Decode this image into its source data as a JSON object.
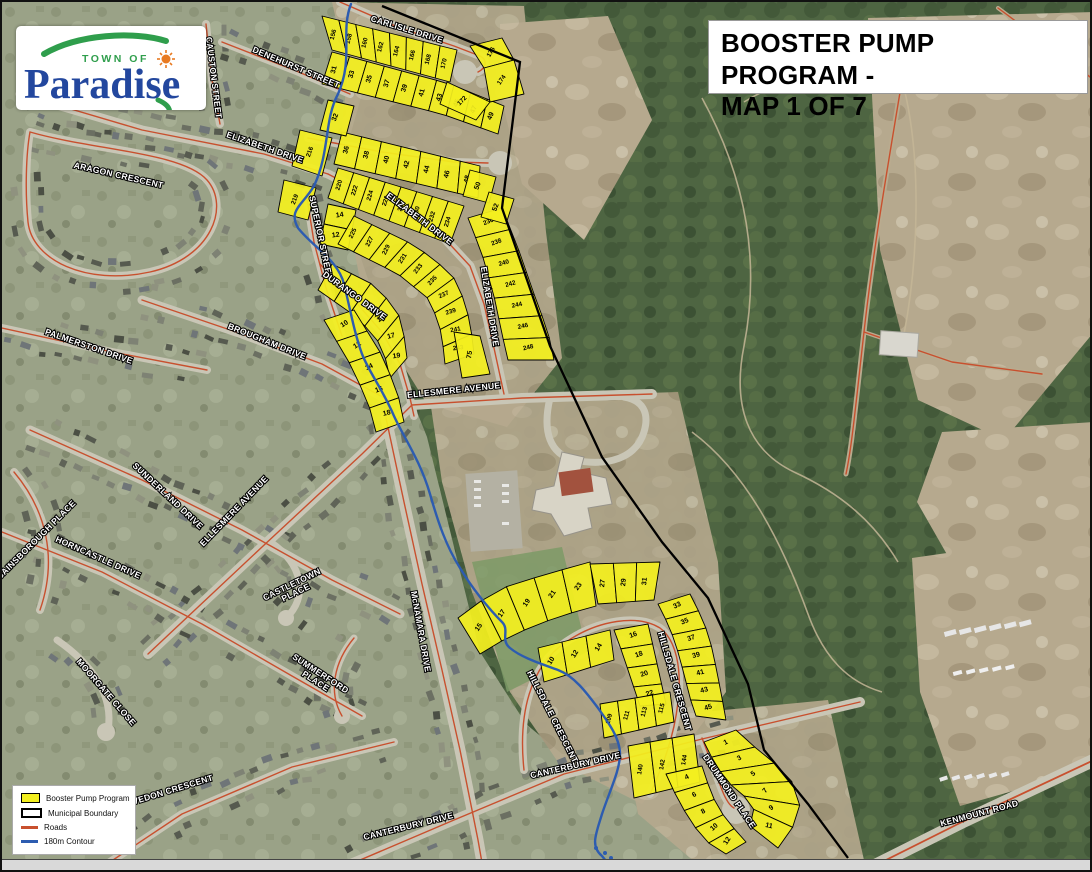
{
  "logo": {
    "top": "TOWN OF",
    "name": "Paradise"
  },
  "title_box": {
    "line1": "BOOSTER PUMP PROGRAM -",
    "line2": "MAP 1 OF 7"
  },
  "legend": {
    "items": [
      {
        "label": "Booster Pump Program",
        "type": "fill",
        "color": "#f3ef1f"
      },
      {
        "label": "Municipal Boundary",
        "type": "outline",
        "color": "#000000"
      },
      {
        "label": "Roads",
        "type": "line",
        "color": "#c8502e"
      },
      {
        "label": "180m Contour",
        "type": "line-thick",
        "color": "#2d5cb0"
      }
    ]
  },
  "map": {
    "colors": {
      "parcel": "#f3ef1f",
      "parcel_stroke": "#000000",
      "road_center": "#c8502e",
      "contour": "#2d5cb0",
      "boundary": "#000000"
    },
    "street_labels": [
      {
        "text": "CARLISLE DRIVE",
        "x": 404,
        "y": 30,
        "rot": 17
      },
      {
        "text": "ELIZABETH DRIVE",
        "x": 262,
        "y": 148,
        "rot": 19
      },
      {
        "text": "DENEHURST STREET",
        "x": 293,
        "y": 68,
        "rot": 23
      },
      {
        "text": "CAUSTON STREET",
        "x": 209,
        "y": 76,
        "rot": 83
      },
      {
        "text": "ARAGON CRESCENT",
        "x": 116,
        "y": 176,
        "rot": 13
      },
      {
        "text": "SUPERIOR STREET",
        "x": 316,
        "y": 236,
        "rot": 78
      },
      {
        "text": "ELIZABETH DRIVE",
        "x": 416,
        "y": 219,
        "rot": 37
      },
      {
        "text": "ELIZABETH DRIVE",
        "x": 485,
        "y": 305,
        "rot": 81
      },
      {
        "text": "DURANGO DRIVE",
        "x": 351,
        "y": 296,
        "rot": 36
      },
      {
        "text": "BROUGHAM DRIVE",
        "x": 264,
        "y": 342,
        "rot": 22
      },
      {
        "text": "PALMERSTON DRIVE",
        "x": 86,
        "y": 347,
        "rot": 19
      },
      {
        "text": "ELLESMERE AVENUE",
        "x": 452,
        "y": 391,
        "rot": -6
      },
      {
        "text": "ELLESMERE AVENUE",
        "x": 234,
        "y": 511,
        "rot": -46
      },
      {
        "text": "SUNDERLAND DRIVE",
        "x": 164,
        "y": 496,
        "rot": 43
      },
      {
        "text": "HORNCASTLE DRIVE",
        "x": 95,
        "y": 558,
        "rot": 24
      },
      {
        "text": "GAINSBOROUGH PLACE",
        "x": 36,
        "y": 540,
        "rot": -45
      },
      {
        "text": "CASTLETOWN",
        "line2": "PLACE",
        "x": 291,
        "y": 585,
        "rot": -26
      },
      {
        "text": "MOORGATE CLOSE",
        "x": 102,
        "y": 692,
        "rot": 49
      },
      {
        "text": "CLEVEDON CRESCENT",
        "x": 163,
        "y": 793,
        "rot": -17
      },
      {
        "text": "SUMMERFORD",
        "line2": "PLACE",
        "x": 317,
        "y": 674,
        "rot": 33
      },
      {
        "text": "McNAMARA DRIVE",
        "x": 416,
        "y": 630,
        "rot": 80
      },
      {
        "text": "HILLSDALE CRESCENT",
        "x": 548,
        "y": 716,
        "rot": 63
      },
      {
        "text": "HILLSDALE CRESCENT",
        "x": 670,
        "y": 680,
        "rot": 74
      },
      {
        "text": "CANTERBURY DRIVE",
        "x": 574,
        "y": 766,
        "rot": -13
      },
      {
        "text": "CANTERBURY DRIVE",
        "x": 407,
        "y": 827,
        "rot": -14
      },
      {
        "text": "DRUMMOND PLACE",
        "x": 725,
        "y": 791,
        "rot": 56
      },
      {
        "text": "KENMOUNT ROAD",
        "x": 978,
        "y": 814,
        "rot": -15
      }
    ],
    "parcel_strips": [
      {
        "lots": [
          "156",
          "158",
          "160",
          "162",
          "164",
          "166",
          "168",
          "170"
        ],
        "p1": [
          [
            320,
            14
          ],
          [
            455,
            48
          ]
        ],
        "p2": [
          [
            330,
            48
          ],
          [
            448,
            80
          ]
        ]
      },
      {
        "lots": [
          "31",
          "33",
          "35",
          "37",
          "39",
          "41",
          "43",
          "45",
          "47",
          "49"
        ],
        "p1": [
          [
            330,
            50
          ],
          [
            448,
            82
          ],
          [
            502,
            104
          ]
        ],
        "p2": [
          [
            320,
            82
          ],
          [
            440,
            112
          ],
          [
            496,
            132
          ]
        ]
      },
      {
        "lots": [
          "36",
          "38",
          "40",
          "42",
          "44",
          "46",
          "48"
        ],
        "p1": [
          [
            340,
            130
          ],
          [
            478,
            164
          ]
        ],
        "p2": [
          [
            332,
            162
          ],
          [
            476,
            196
          ]
        ]
      },
      {
        "lots": [
          "220",
          "222",
          "224",
          "226",
          "228",
          "230",
          "232",
          "234"
        ],
        "p1": [
          [
            336,
            166
          ],
          [
            462,
            204
          ]
        ],
        "p2": [
          [
            326,
            196
          ],
          [
            448,
            242
          ]
        ]
      },
      {
        "lots": [
          "236",
          "238",
          "240",
          "242",
          "244",
          "246",
          "248"
        ],
        "p1": [
          [
            466,
            216
          ],
          [
            480,
            252
          ],
          [
            492,
            294
          ],
          [
            500,
            332
          ],
          [
            506,
            358
          ]
        ],
        "p2": [
          [
            500,
            206
          ],
          [
            516,
            246
          ],
          [
            532,
            292
          ],
          [
            546,
            330
          ],
          [
            552,
            358
          ]
        ]
      },
      {
        "lots": [
          "14",
          "12"
        ],
        "rot": -8,
        "p1": [
          [
            326,
            202
          ],
          [
            318,
            242
          ]
        ],
        "p2": [
          [
            354,
            208
          ],
          [
            346,
            248
          ]
        ]
      },
      {
        "lots": [
          "225",
          "227",
          "229",
          "231",
          "233",
          "235",
          "237",
          "239",
          "241",
          "243"
        ],
        "p1": [
          [
            352,
            214
          ],
          [
            414,
            244
          ],
          [
            450,
            272
          ],
          [
            464,
            302
          ],
          [
            470,
            334
          ],
          [
            472,
            352
          ]
        ],
        "p2": [
          [
            336,
            242
          ],
          [
            396,
            272
          ],
          [
            428,
            298
          ],
          [
            438,
            326
          ],
          [
            442,
            350
          ],
          [
            443,
            362
          ]
        ]
      },
      {
        "lots": [
          "9",
          "11",
          "13",
          "15",
          "17",
          "19"
        ],
        "p1": [
          [
            330,
            262
          ],
          [
            374,
            284
          ],
          [
            396,
            310
          ],
          [
            403,
            338
          ],
          [
            405,
            356
          ]
        ],
        "p2": [
          [
            316,
            288
          ],
          [
            356,
            316
          ],
          [
            380,
            344
          ],
          [
            386,
            366
          ],
          [
            388,
            376
          ]
        ]
      },
      {
        "lots": [
          "10",
          "12",
          "14",
          "16",
          "18"
        ],
        "p1": [
          [
            352,
            308
          ],
          [
            378,
            350
          ],
          [
            395,
            388
          ],
          [
            402,
            420
          ]
        ],
        "p2": [
          [
            322,
            318
          ],
          [
            348,
            362
          ],
          [
            366,
            400
          ],
          [
            374,
            430
          ]
        ]
      },
      {
        "lots": [
          "15",
          "17",
          "19",
          "21",
          "23"
        ],
        "rot": -55,
        "p1": [
          [
            478,
            652
          ],
          [
            508,
            634
          ],
          [
            542,
            620
          ],
          [
            572,
            610
          ],
          [
            594,
            604
          ]
        ],
        "p2": [
          [
            456,
            616
          ],
          [
            494,
            588
          ],
          [
            532,
            576
          ],
          [
            566,
            566
          ],
          [
            588,
            560
          ]
        ]
      },
      {
        "lots": [
          "27",
          "29",
          "31"
        ],
        "rot": -84,
        "p1": [
          [
            596,
            602
          ],
          [
            652,
            598
          ]
        ],
        "p2": [
          [
            588,
            562
          ],
          [
            658,
            560
          ]
        ]
      },
      {
        "lots": [
          "33",
          "35",
          "37",
          "39",
          "41",
          "43",
          "45"
        ],
        "p1": [
          [
            656,
            602
          ],
          [
            668,
            626
          ],
          [
            676,
            650
          ],
          [
            682,
            672
          ],
          [
            688,
            696
          ],
          [
            694,
            714
          ]
        ],
        "p2": [
          [
            688,
            592
          ],
          [
            702,
            620
          ],
          [
            710,
            646
          ],
          [
            715,
            670
          ],
          [
            720,
            696
          ],
          [
            724,
            718
          ]
        ]
      },
      {
        "lots": [
          "10",
          "12",
          "14"
        ],
        "rot": -58,
        "p1": [
          [
            536,
            646
          ],
          [
            608,
            628
          ]
        ],
        "p2": [
          [
            542,
            680
          ],
          [
            612,
            658
          ]
        ]
      },
      {
        "lots": [
          "16",
          "18",
          "20",
          "22"
        ],
        "p1": [
          [
            612,
            628
          ],
          [
            620,
            650
          ],
          [
            626,
            668
          ],
          [
            632,
            686
          ],
          [
            638,
            704
          ]
        ],
        "p2": [
          [
            646,
            622
          ],
          [
            652,
            648
          ],
          [
            656,
            666
          ],
          [
            660,
            684
          ],
          [
            664,
            702
          ]
        ]
      },
      {
        "lots": [
          "109",
          "111",
          "113",
          "115"
        ],
        "rot": -75,
        "p1": [
          [
            598,
            702
          ],
          [
            668,
            690
          ]
        ],
        "p2": [
          [
            602,
            736
          ],
          [
            672,
            720
          ]
        ]
      },
      {
        "lots": [
          "140",
          "142",
          "144"
        ],
        "rot": -80,
        "p1": [
          [
            626,
            744
          ],
          [
            692,
            732
          ]
        ],
        "p2": [
          [
            632,
            796
          ],
          [
            698,
            780
          ]
        ]
      },
      {
        "lots": [
          "1",
          "3",
          "5",
          "7",
          "9",
          "11"
        ],
        "p1": [
          [
            702,
            740
          ],
          [
            714,
            764
          ],
          [
            728,
            782
          ],
          [
            742,
            794
          ],
          [
            752,
            806
          ],
          [
            748,
            824
          ]
        ],
        "p2": [
          [
            734,
            728
          ],
          [
            756,
            748
          ],
          [
            776,
            764
          ],
          [
            792,
            782
          ],
          [
            800,
            812
          ],
          [
            776,
            846
          ]
        ]
      },
      {
        "lots": [
          "4",
          "6",
          "8",
          "10",
          "12"
        ],
        "p1": [
          [
            664,
            772
          ],
          [
            676,
            798
          ],
          [
            688,
            818
          ],
          [
            702,
            838
          ],
          [
            724,
            852
          ]
        ],
        "p2": [
          [
            700,
            764
          ],
          [
            708,
            788
          ],
          [
            716,
            806
          ],
          [
            728,
            822
          ],
          [
            744,
            840
          ]
        ]
      }
    ],
    "parcel_polys": [
      {
        "label": "216",
        "rot": -70,
        "pts": [
          [
            298,
            128
          ],
          [
            330,
            136
          ],
          [
            320,
            174
          ],
          [
            290,
            164
          ]
        ]
      },
      {
        "label": "219",
        "rot": -70,
        "pts": [
          [
            282,
            178
          ],
          [
            314,
            186
          ],
          [
            306,
            218
          ],
          [
            276,
            210
          ]
        ]
      },
      {
        "label": "32",
        "rot": -70,
        "pts": [
          [
            326,
            98
          ],
          [
            352,
            104
          ],
          [
            344,
            134
          ],
          [
            318,
            128
          ]
        ]
      },
      {
        "label": "50",
        "rot": -70,
        "pts": [
          [
            468,
            168
          ],
          [
            494,
            175
          ],
          [
            487,
            201
          ],
          [
            461,
            194
          ]
        ]
      },
      {
        "label": "52",
        "rot": -70,
        "pts": [
          [
            487,
            190
          ],
          [
            512,
            197
          ],
          [
            504,
            222
          ],
          [
            479,
            215
          ]
        ]
      },
      {
        "label": "75",
        "rot": -80,
        "pts": [
          [
            452,
            330
          ],
          [
            478,
            334
          ],
          [
            488,
            372
          ],
          [
            460,
            376
          ]
        ]
      },
      {
        "label": "176",
        "rot": -60,
        "pts": [
          [
            468,
            44
          ],
          [
            500,
            36
          ],
          [
            512,
            58
          ],
          [
            482,
            66
          ]
        ]
      },
      {
        "label": "174",
        "rot": -55,
        "pts": [
          [
            482,
            66
          ],
          [
            512,
            58
          ],
          [
            522,
            92
          ],
          [
            488,
            100
          ]
        ]
      },
      {
        "label": "172",
        "rot": -45,
        "pts": [
          [
            445,
            80
          ],
          [
            488,
            100
          ],
          [
            474,
            118
          ],
          [
            438,
            102
          ]
        ]
      }
    ]
  }
}
